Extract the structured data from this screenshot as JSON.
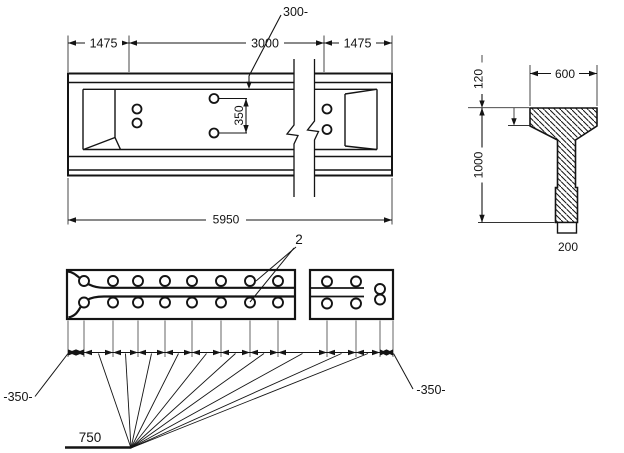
{
  "side_view": {
    "dim_left": "1475",
    "dim_mid": "3000",
    "dim_right": "1475",
    "dim_total": "5950",
    "leader_top": "300-",
    "dim_hole_spacing": "350"
  },
  "cross_section": {
    "dim_flange_width": "600",
    "dim_flange_thickness": "120",
    "dim_height": "1000",
    "dim_web_width": "200"
  },
  "plan_view": {
    "callout_holes": "2",
    "dim_end_left": "-350-",
    "dim_end_right": "-350-",
    "dim_spacing": "750"
  }
}
